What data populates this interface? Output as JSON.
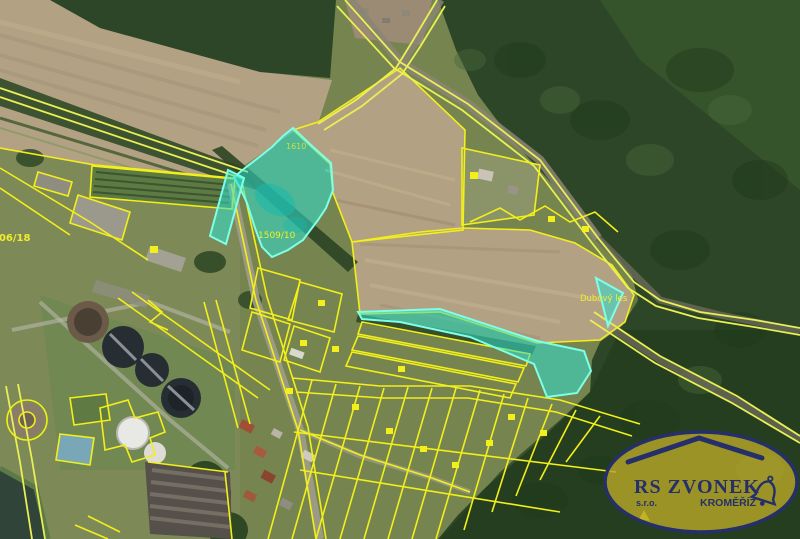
{
  "map": {
    "type": "aerial-cadastral-map",
    "labels": {
      "parcel_highlight": "1509/10",
      "parcel_left_edge": "506/18",
      "parcel_upper": "1610",
      "forest_name": "Dubový les"
    },
    "highlight_color": "#2fe0cf",
    "boundary_color": "#f2ef1a",
    "highlighted_parcels": [
      "left-large-parcel",
      "left-sliver-parcel",
      "right-strip-parcel",
      "right-triangle-parcel"
    ]
  },
  "logo": {
    "company": "RS ZVONEK",
    "legal_form": "s.r.o.",
    "city": "KROMĚŘÍŽ",
    "text_color": "#25306b",
    "background_color": "#b7a62a"
  }
}
